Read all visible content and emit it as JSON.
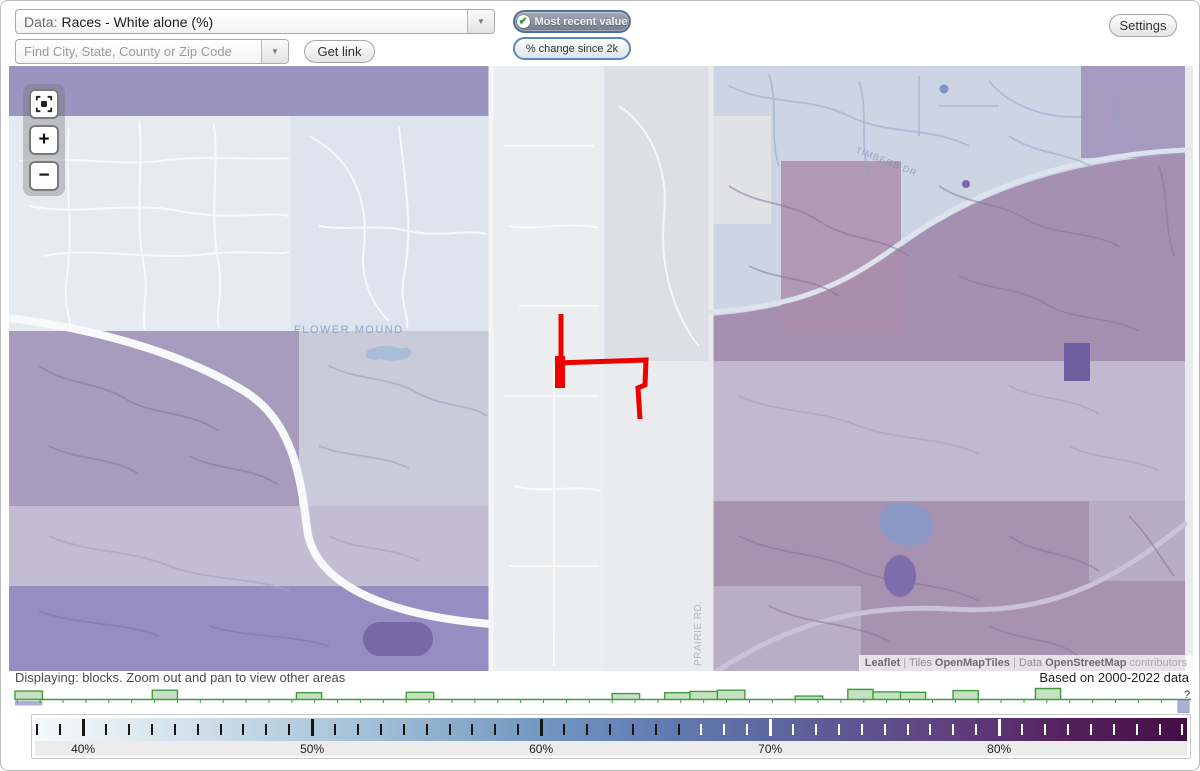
{
  "header": {
    "data_selector": {
      "prefix": "Data:",
      "value": "Races - White alone (%)"
    },
    "search": {
      "placeholder": "Find City, State, County or Zip Code"
    },
    "get_link_label": "Get link",
    "toggle_recent_label": "Most recent value",
    "toggle_change_label": "% change since 2k",
    "settings_label": "Settings",
    "check_glyph": "✔",
    "dropdown_arrow_glyph": "▼"
  },
  "map": {
    "controls": {
      "zoom_in": "+",
      "zoom_out": "−"
    },
    "place_label": "FLOWER MOUND",
    "road_label_vertical": "PRAIRIE RD.",
    "road_label_faint": "TIMBERS DR",
    "annotation": {
      "color": "#ec0000",
      "paths": [
        {
          "d": "M552,248 L552,322",
          "w": 5
        },
        {
          "d": "M551,290 L551,322",
          "w": 10
        },
        {
          "d": "M546,297 L637,294 L636,319 L629,322 L631,353",
          "w": 5
        }
      ]
    },
    "attribution": {
      "leaflet": "Leaflet",
      "sep1": " | ",
      "tiles_word": "Tiles ",
      "tiles_name": "OpenMapTiles",
      "sep2": " | ",
      "data_word": "Data ",
      "data_name": "OpenStreetMap",
      "contributors": " contributors"
    }
  },
  "status": {
    "displaying": "Displaying: blocks. Zoom out and pan to view other areas",
    "based_on": "Based on 2000-2022 data"
  },
  "chart_data": [
    {
      "type": "histogram",
      "title": "Distribution of census block values",
      "x_unit": "% White alone",
      "x_range": [
        36.9,
        88.3
      ],
      "bars": [
        {
          "from": 36.9,
          "to": 38.1,
          "h": 0.77,
          "highlighted": true
        },
        {
          "from": 42.9,
          "to": 44.0,
          "h": 0.85
        },
        {
          "from": 49.2,
          "to": 50.3,
          "h": 0.62
        },
        {
          "from": 54.0,
          "to": 55.2,
          "h": 0.65
        },
        {
          "from": 63.0,
          "to": 64.2,
          "h": 0.54
        },
        {
          "from": 65.3,
          "to": 66.4,
          "h": 0.62
        },
        {
          "from": 66.4,
          "to": 67.6,
          "h": 0.73
        },
        {
          "from": 67.6,
          "to": 68.8,
          "h": 0.85
        },
        {
          "from": 71.0,
          "to": 72.2,
          "h": 0.31
        },
        {
          "from": 73.3,
          "to": 74.4,
          "h": 0.92
        },
        {
          "from": 74.4,
          "to": 75.6,
          "h": 0.69
        },
        {
          "from": 75.6,
          "to": 76.7,
          "h": 0.65
        },
        {
          "from": 77.9,
          "to": 79.0,
          "h": 0.81
        },
        {
          "from": 81.5,
          "to": 82.6,
          "h": 1.0
        }
      ],
      "line_color": "#3f9b41",
      "fill_color": "#b7dab2",
      "highlight_color": "#a9afd6",
      "overflow_marker_color": "#abb0d4",
      "help_symbol": "?"
    },
    {
      "type": "color-scale",
      "unit": "%",
      "min": 37.9,
      "max": 88.2,
      "major_ticks": [
        {
          "value": 40,
          "label": "40%"
        },
        {
          "value": 50,
          "label": "50%"
        },
        {
          "value": 60,
          "label": "60%"
        },
        {
          "value": 70,
          "label": "70%"
        },
        {
          "value": 80,
          "label": "80%"
        }
      ],
      "minor_tick_step": 1,
      "tick_dark_color": "#151515",
      "tick_light_color": "#ffffff",
      "tick_color_switch_value": 66.5,
      "gradient_stops": [
        {
          "pos": 0.0,
          "color": "#f5fafb"
        },
        {
          "pos": 0.05,
          "color": "#e9f1f6"
        },
        {
          "pos": 0.15,
          "color": "#cddee9"
        },
        {
          "pos": 0.3,
          "color": "#9fbdd6"
        },
        {
          "pos": 0.45,
          "color": "#7094bf"
        },
        {
          "pos": 0.55,
          "color": "#617ab0"
        },
        {
          "pos": 0.64,
          "color": "#5c689f"
        },
        {
          "pos": 0.72,
          "color": "#5e538e"
        },
        {
          "pos": 0.8,
          "color": "#5f3e7d"
        },
        {
          "pos": 0.9,
          "color": "#54205c"
        },
        {
          "pos": 1.0,
          "color": "#440d45"
        }
      ]
    }
  ]
}
